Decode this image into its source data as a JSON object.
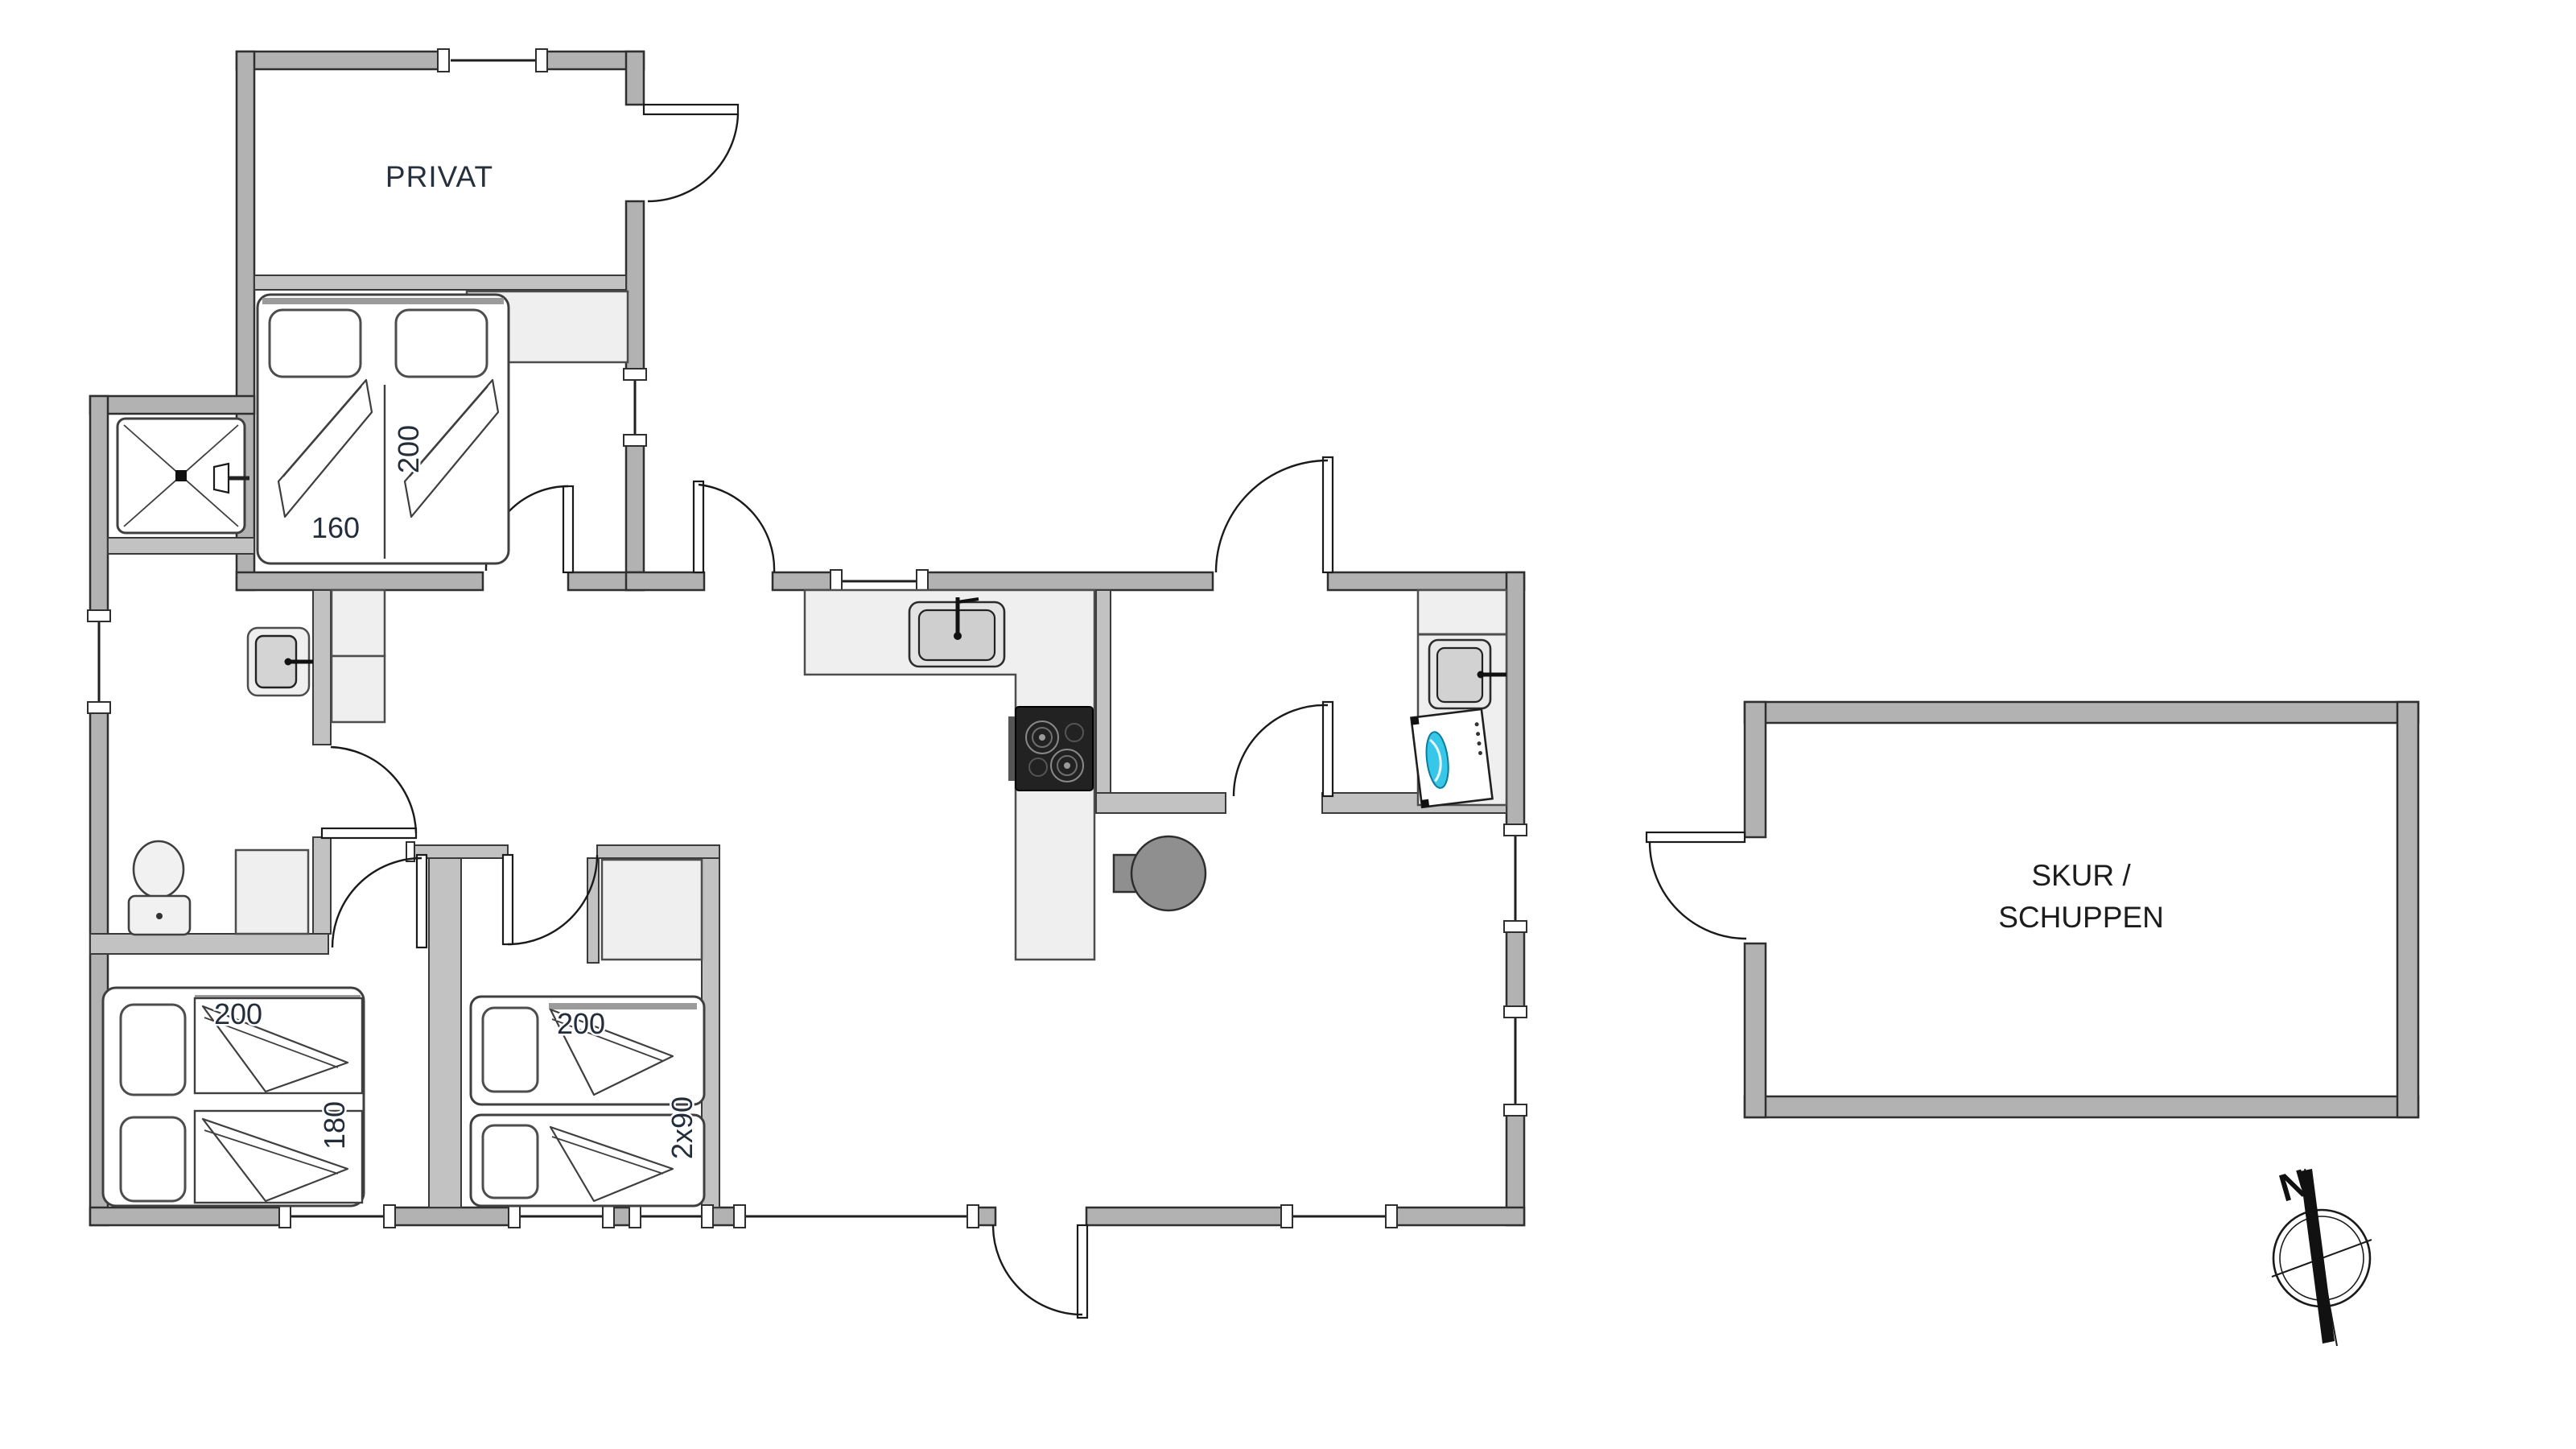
{
  "page": {
    "type": "floor-plan-drawing",
    "background": "#ffffff"
  },
  "labels": {
    "private_room": "PRIVAT",
    "shed_line1": "SKUR /",
    "shed_line2": "SCHUPPEN",
    "compass_north": "N",
    "bedroom1": {
      "length": "200",
      "width": "160"
    },
    "bedroom2": {
      "length": "200",
      "width": "180"
    },
    "bedroom3": {
      "length": "200",
      "width": "2x90"
    }
  },
  "colors": {
    "wall_fill": "#b2b2b2",
    "interior_wall_fill": "#c2c2c2",
    "outline": "#2f2f2f",
    "furniture_fill": "#efefef",
    "cooktop_fill": "#222222",
    "wood_stove_fill": "#8f8f8f",
    "washer_accent": "#36c7e9",
    "label_color": "#26313d"
  },
  "symbols": [
    "double-bed-icon",
    "single-bed-icon",
    "pillow-icon",
    "blanket-icon",
    "wardrobe-icon",
    "shower-icon",
    "toilet-icon",
    "washbasin-icon",
    "kitchen-sink-icon",
    "cooktop-icon",
    "wood-stove-icon",
    "washing-machine-icon",
    "door-swing-icon",
    "window-icon",
    "compass-icon"
  ]
}
